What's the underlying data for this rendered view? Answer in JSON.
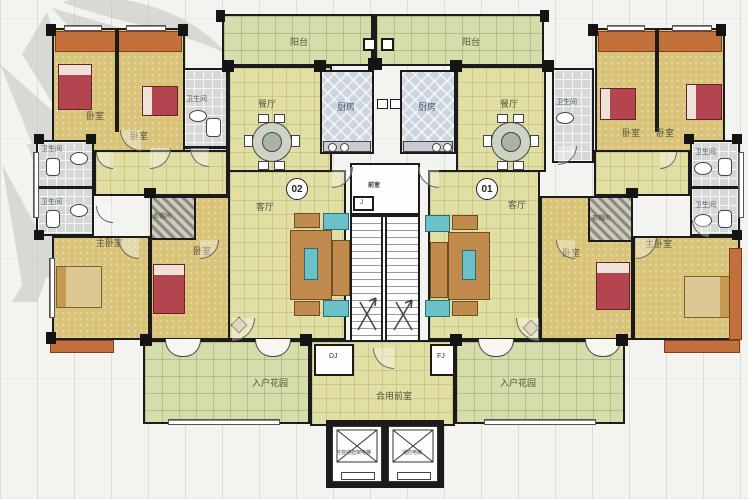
{
  "title": "residential-floor-plan",
  "units": {
    "left": {
      "number": "02"
    },
    "right": {
      "number": "01"
    }
  },
  "labels": {
    "balcony_left": "阳台",
    "balcony_right": "阳台",
    "dining_left": "餐厅",
    "dining_right": "餐厅",
    "kitchen_left": "厨房",
    "kitchen_right": "厨房",
    "living_left": "客厅",
    "living_right": "客厅",
    "bath_hall_left": "卫生间",
    "bath_hall_right": "卫生间",
    "bath_left_upper": "卫生间",
    "bath_left_lower": "卫生间",
    "bath_right_upper": "卫生间",
    "bath_right_lower": "卫生间",
    "bedroom_left_a": "卧室",
    "bedroom_left_b": "卧室",
    "bedroom_left_c": "卧室",
    "bedroom_right_a": "卧室",
    "bedroom_right_b": "卧室",
    "bedroom_right_c": "卧室",
    "master_left": "主卧室",
    "master_right": "主卧室",
    "closet_left": "衣帽间",
    "closet_right": "衣帽间",
    "garden_left": "入户花园",
    "garden_right": "入户花园",
    "lobby": "合用前室",
    "stair_front": "前室",
    "shaft_j": "J",
    "shaft_dj": "DJ",
    "shaft_fj": "FJ",
    "elevator_left": "可容纳担架电梯",
    "elevator_right": "消防电梯"
  },
  "colors": {
    "wall": "#1b1b1b",
    "bedroom_floor": "#d8c378",
    "living_floor": "#e2dfa5",
    "garden_floor": "#d6dcab",
    "bath_floor": "#d5d8d7",
    "kitchen_floor": "#ccd4de",
    "accent_orange": "#c4703c",
    "bed_red": "#b2454e",
    "tv_cyan": "#6cc0c8"
  }
}
